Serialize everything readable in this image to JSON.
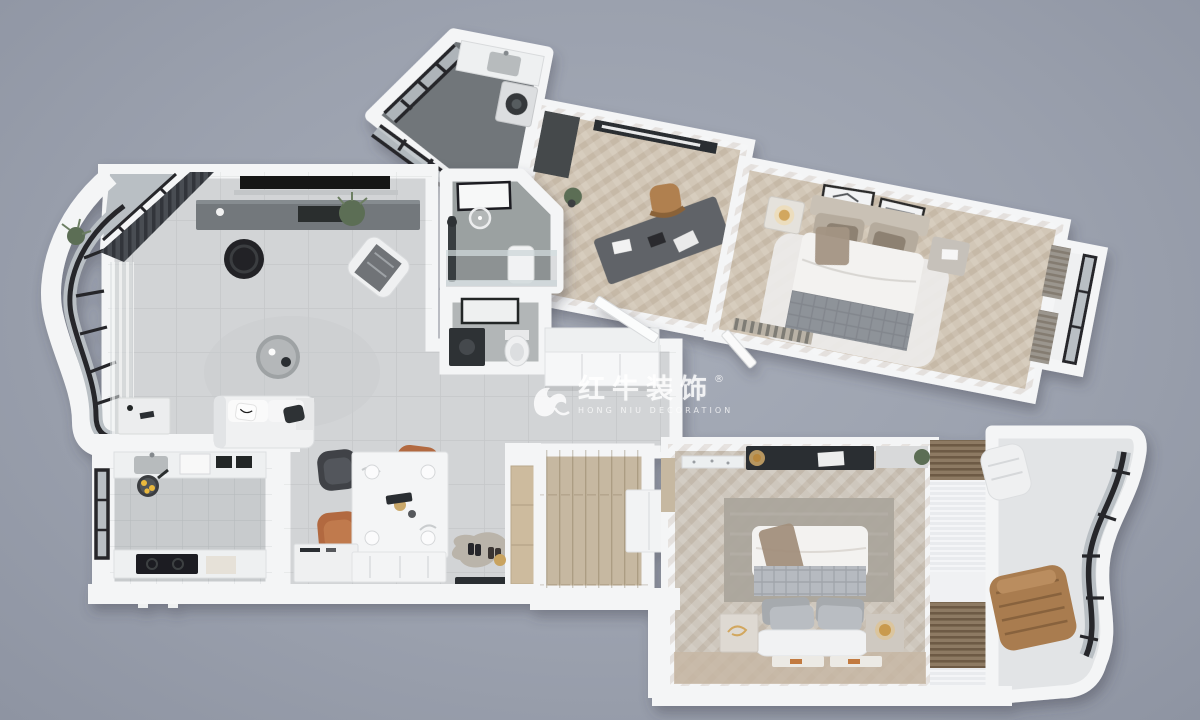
{
  "watermark": {
    "logo_icon": "bull-swoosh-icon",
    "registered": "®",
    "brand": "红牛装饰",
    "subtitle": "HONG NIU DECORATION"
  },
  "colors": {
    "bg": "#9ba1ae",
    "bgMid": "#a7adb9",
    "bgEdge": "#8e94a2",
    "wall": "#f4f5f6",
    "wallShade": "#dddfe2",
    "tile": "#d2d4d6",
    "tileKitchen": "#c8cbcd",
    "bath1": "#9ba1a1",
    "bath2": "#b2b6b7",
    "laundry": "#71767a",
    "herr": "#d2c7b7",
    "herrGray": "#cec7bd",
    "plank": "#c6b8a1",
    "woodCab": "#cdbb9e",
    "dark": "#1f2124",
    "charcoal": "#33373b",
    "graphite": "#5f6367",
    "console": "#73787c",
    "glass": "#b9bfc4",
    "frame": "#26282b",
    "orange": "#b2693f",
    "tan": "#b08050",
    "brown": "#a97c4f",
    "green": "#5c6e54",
    "gold": "#d2a75e",
    "rug": "#aba59c",
    "fluffy": "#edecea",
    "duvet": "#f3f2f0",
    "blanket": "#8e9399",
    "sheer": "#e9ebee",
    "drape": "#4a4e53",
    "slat": "#8d7a63",
    "marble": "#eceff0"
  }
}
